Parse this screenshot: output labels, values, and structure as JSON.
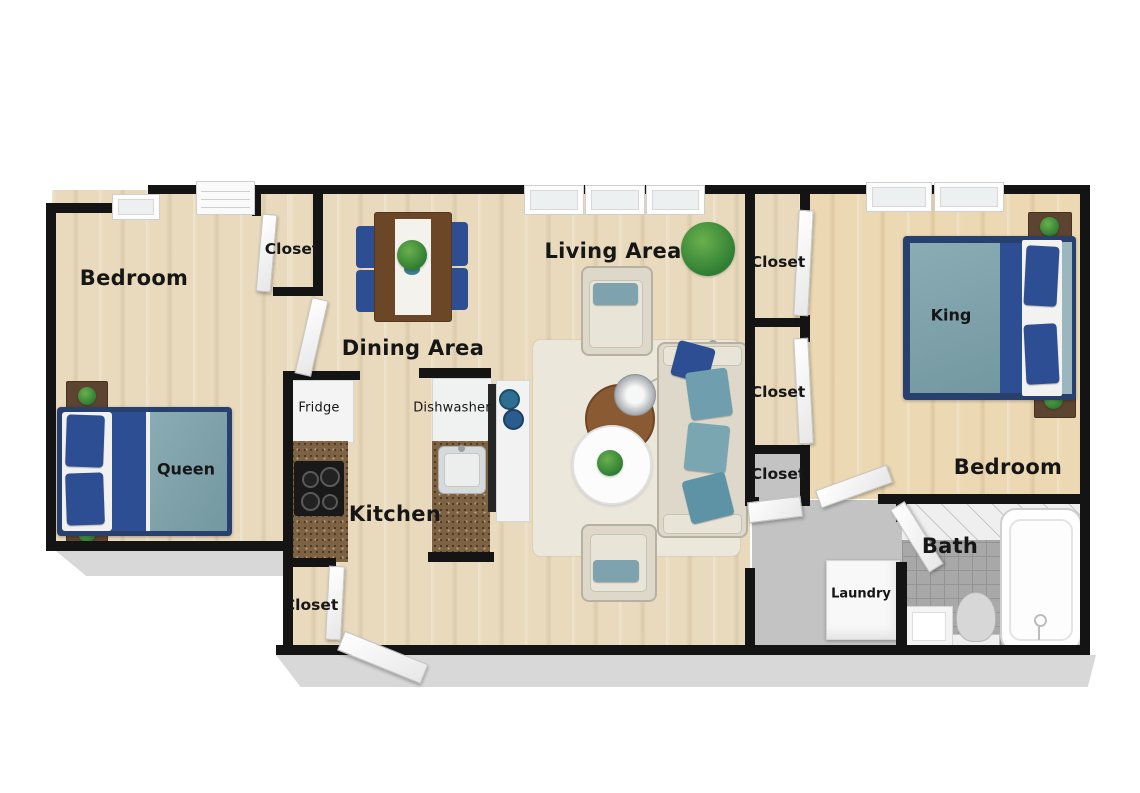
{
  "plan": {
    "left_bedroom": {
      "label": "Bedroom",
      "bed_size": "Queen",
      "closet_label": "Closet"
    },
    "dining_area": {
      "label": "Dining Area"
    },
    "kitchen": {
      "label": "Kitchen",
      "fridge_label": "Fridge",
      "dishwasher_label": "Dishwasher",
      "closet_label": "Closet"
    },
    "living_area": {
      "label": "Living Area"
    },
    "hall_closets": {
      "closet_1_label": "Closet",
      "closet_2_label": "Closet",
      "closet_3_label": "Closet"
    },
    "right_bedroom": {
      "label": "Bedroom",
      "bed_size": "King"
    },
    "bathroom": {
      "label": "Bath"
    },
    "laundry": {
      "label": "Laundry"
    },
    "colors": {
      "wall": "#141414",
      "wood_floor": "#e9dabd",
      "wood_floor_warm": "#ecd9b4",
      "hall_gray": "#c3c3c3",
      "bath_tile_gray": "#a8a8a8",
      "bed_navy": "#2d4e93",
      "blanket_teal": "#7fa3ae",
      "sofa_cream": "#ddd8ca",
      "rug_cream": "#ece7db",
      "granite_brown": "#7e6244",
      "table_brown": "#6b4728",
      "plant_green": "#3c8e3c",
      "door_white": "#ffffff"
    }
  }
}
